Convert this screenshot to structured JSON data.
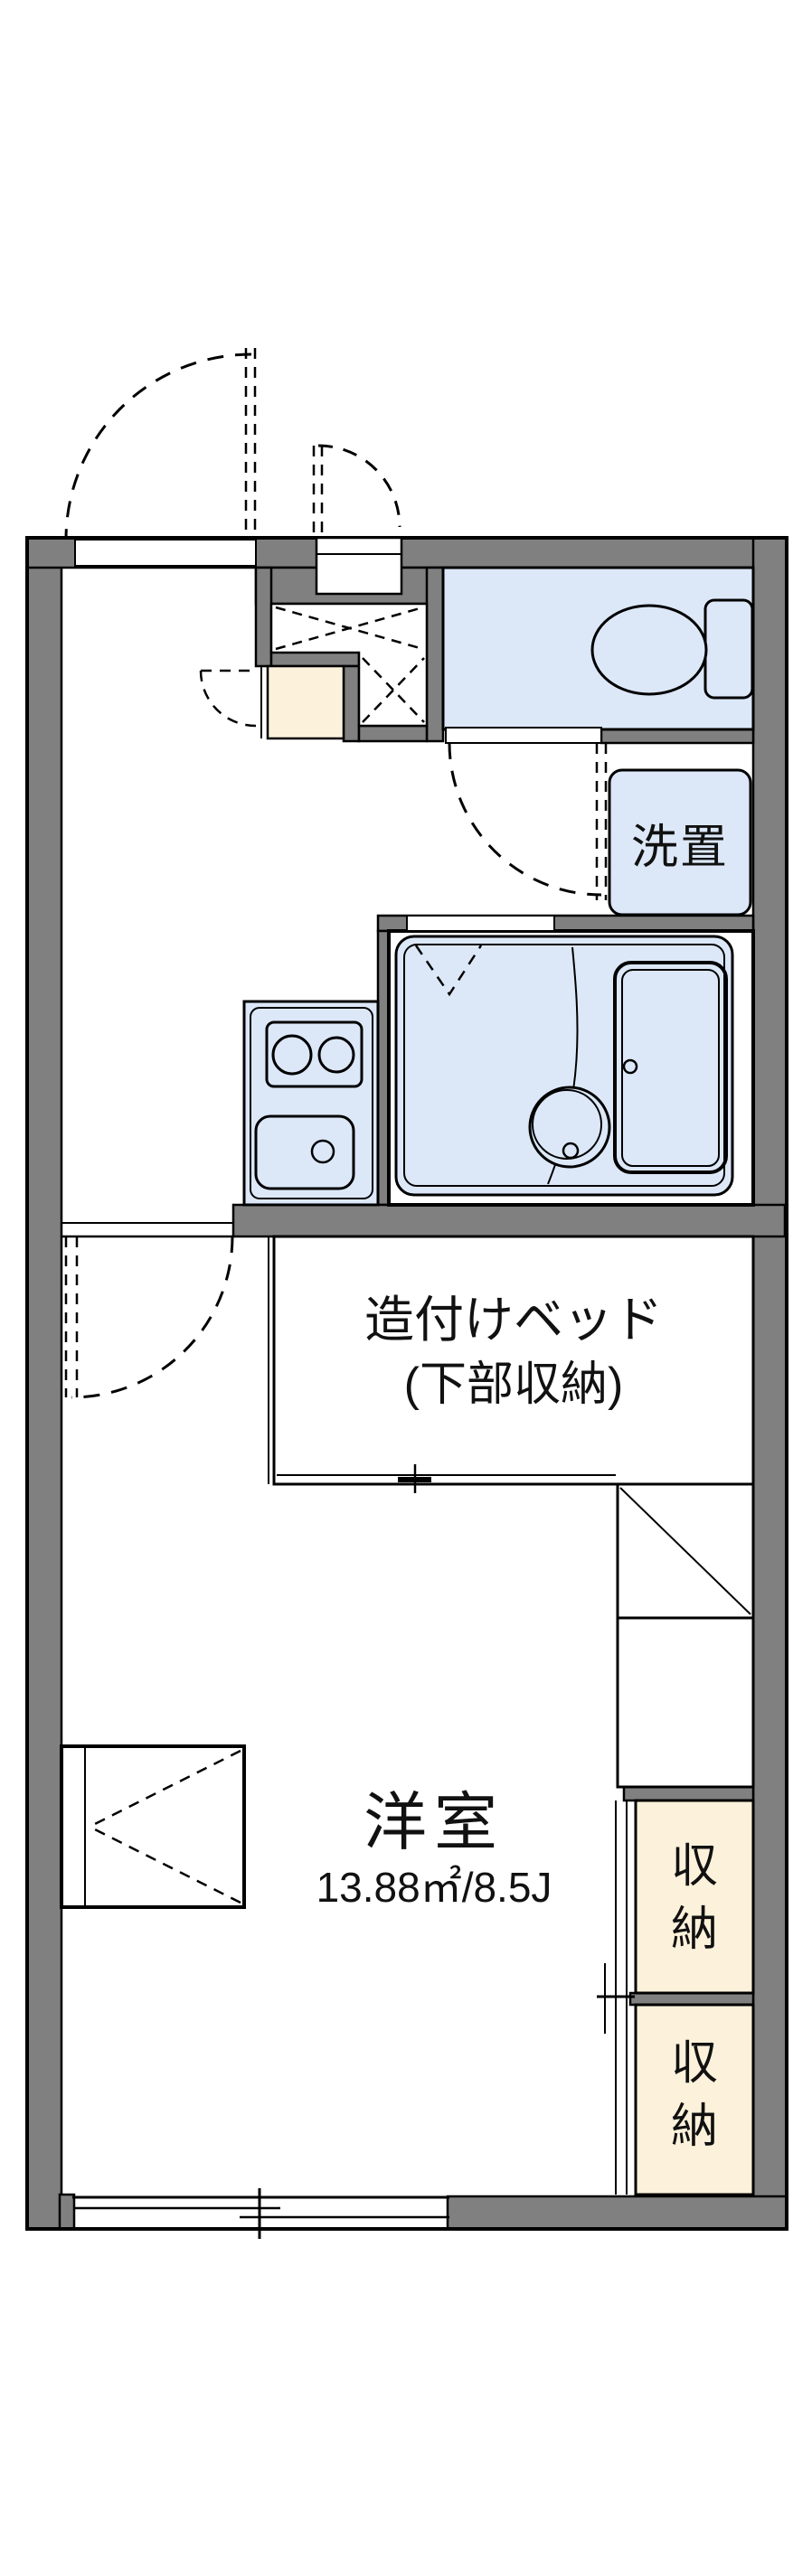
{
  "floorplan": {
    "labels": {
      "laundry": "洗置",
      "bed_line1": "造付けベッド",
      "bed_line2": "(下部収納)",
      "room_name": "洋室",
      "room_size": "13.88㎡/8.5J",
      "storage_upper": "収納",
      "storage_lower": "収納"
    },
    "fixtures": [
      "entrance-door-swing",
      "entrance-step",
      "pipe-space-crossmark",
      "toilet",
      "toilet-tank",
      "laundry-machine-space",
      "toilet-door-swing",
      "bathroom-unit",
      "bathtub",
      "wash-basin",
      "bathroom-folding-door",
      "kitchen-counter",
      "two-burner-stove",
      "kitchen-sink",
      "room-door-swing",
      "built-in-bed",
      "refrigerator-space",
      "shelf-space",
      "storage-closet-upper",
      "storage-closet-lower",
      "closet-sliding-doors",
      "bay-window",
      "sliding-window"
    ],
    "colors": {
      "wall_gray": "#808080",
      "water_blue": "#dce8f8",
      "cream": "#fcf1da",
      "line_black": "#000000",
      "background": "#ffffff"
    }
  }
}
